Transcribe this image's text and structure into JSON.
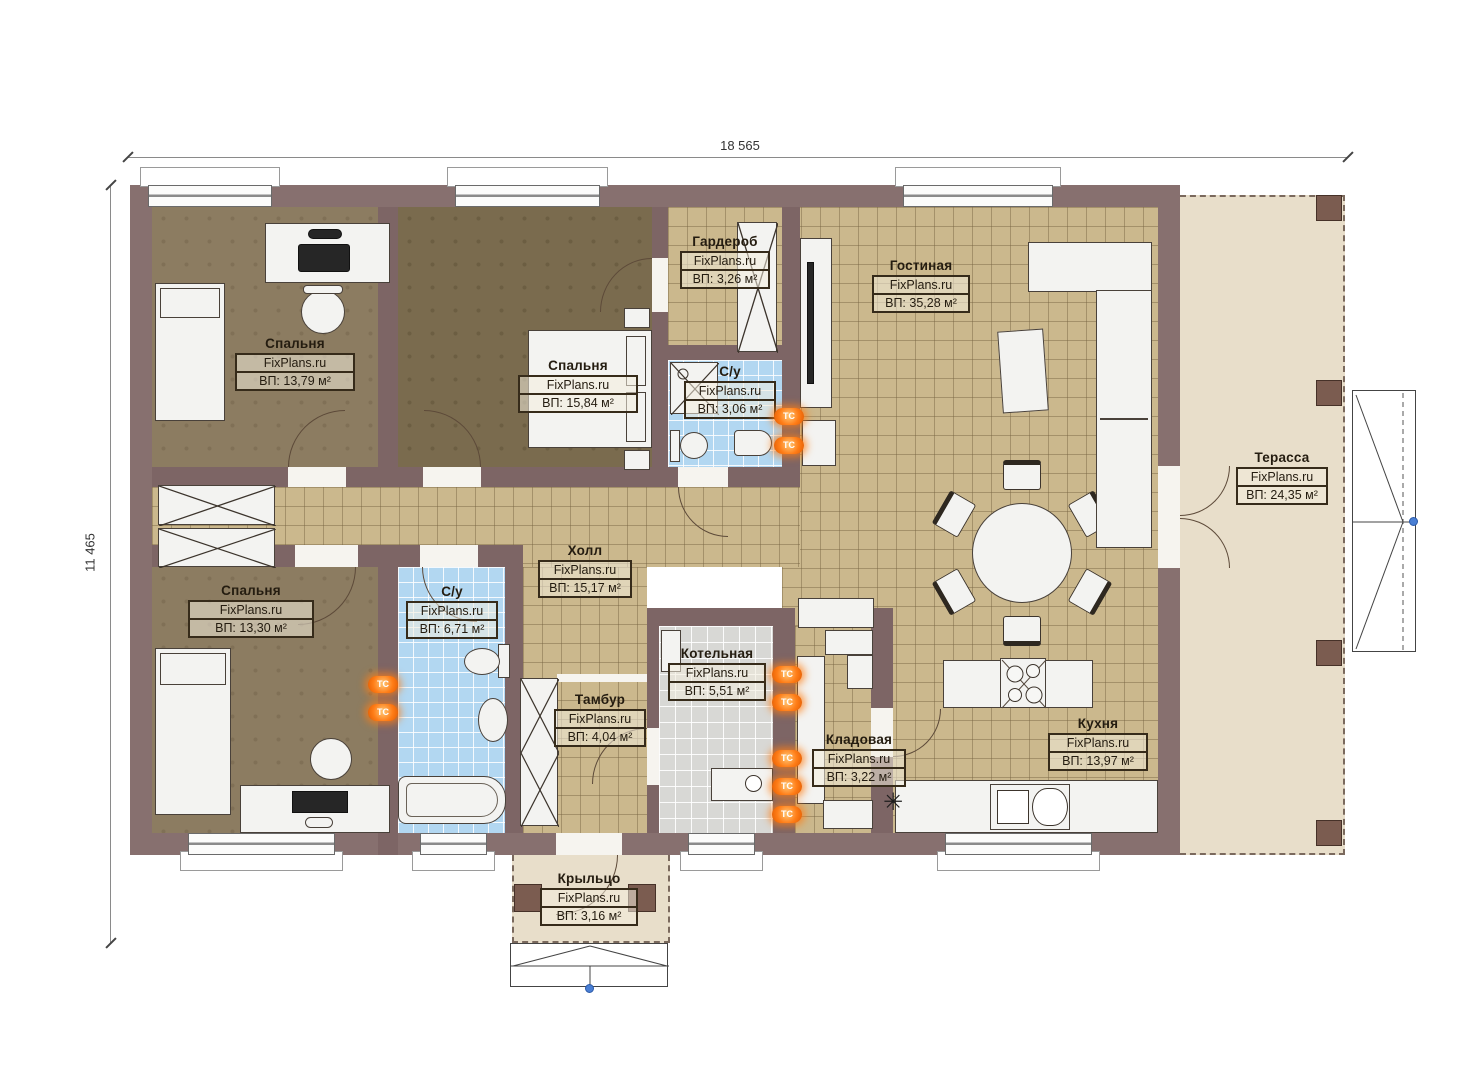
{
  "dimensions": {
    "top": "18 565",
    "left": "11 465"
  },
  "brand": "FixPlans.ru",
  "rooms": [
    {
      "name": "Спальня",
      "area": "ВП: 13,79 м²"
    },
    {
      "name": "Спальня",
      "area": "ВП: 15,84 м²"
    },
    {
      "name": "Гардероб",
      "area": "ВП: 3,26 м²"
    },
    {
      "name": "С/у",
      "area": "ВП: 3,06 м²"
    },
    {
      "name": "Гостиная",
      "area": "ВП: 35,28 м²"
    },
    {
      "name": "Терасса",
      "area": "ВП: 24,35 м²"
    },
    {
      "name": "Холл",
      "area": "ВП: 15,17 м²"
    },
    {
      "name": "Спальня",
      "area": "ВП: 13,30 м²"
    },
    {
      "name": "С/у",
      "area": "ВП: 6,71 м²"
    },
    {
      "name": "Тамбур",
      "area": "ВП: 4,04 м²"
    },
    {
      "name": "Котельная",
      "area": "ВП: 5,51 м²"
    },
    {
      "name": "Кладовая",
      "area": "ВП: 3,22 м²"
    },
    {
      "name": "Кухня",
      "area": "ВП: 13,97 м²"
    },
    {
      "name": "Крыльцо",
      "area": "ВП: 3,16 м²"
    }
  ],
  "icons": {
    "heating_label": "ТС",
    "freezer_glyph": "✳"
  },
  "colors": {
    "wall": "#87706f",
    "tile": "#cbb88d",
    "wet_tile": "#b2d7f1",
    "terrace": "#e8deca",
    "badge": "#ff7d17"
  }
}
